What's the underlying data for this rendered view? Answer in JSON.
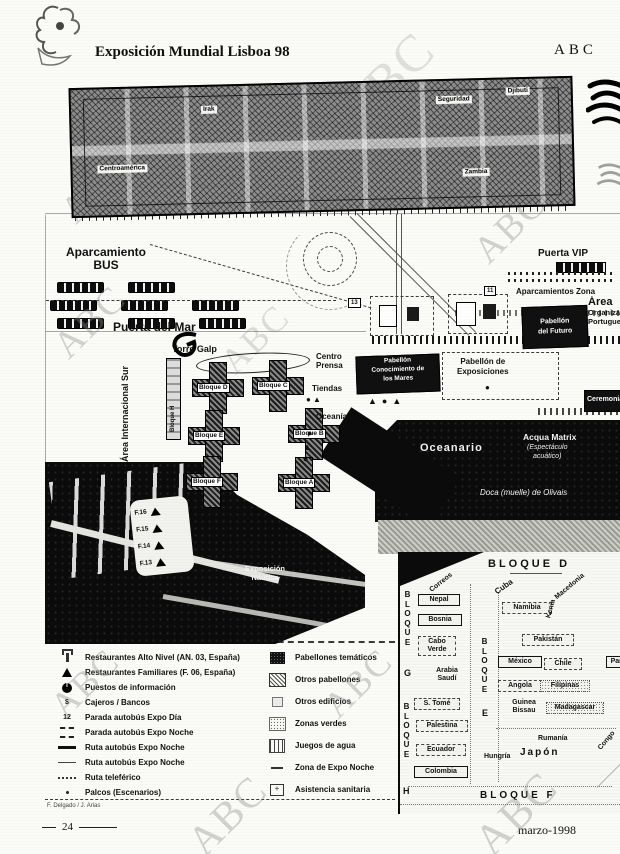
{
  "page": {
    "title": "Exposición Mundial Lisboa 98",
    "brand": "ABC",
    "watermark": "ABC",
    "page_number": "24",
    "date": "marzo-1998",
    "credit": "F. Delgado / J. Arias"
  },
  "top_map": {
    "labels": {
      "irak": "Irak",
      "centroamerica": "Centroamérica",
      "seguridad": "Seguridad",
      "djibuti": "Djibuti",
      "zambia": "Zambia"
    }
  },
  "main_map": {
    "aparcamiento_line1": "Aparcamiento",
    "aparcamiento_line2": "BUS",
    "puerta_del_mar": "Puerta del Mar",
    "torre_galp": "Torre Galp",
    "area_internacional_sur": "Área Internacional Sur",
    "bloque_h_strip": "Bloque H",
    "centro_prensa_line1": "Centro",
    "centro_prensa_line2": "Prensa",
    "tiendas": "Tiendas",
    "oceania": "Oceanía",
    "bloques": [
      "Bloque D",
      "Bloque C",
      "Bloque B",
      "Bloque E",
      "Bloque F",
      "Bloque A"
    ],
    "pabellon_exposiciones_line1": "Pabellón de",
    "pabellon_exposiciones_line2": "Exposiciones",
    "pabellon_futuro_line1": "Pabellón",
    "pabellon_futuro_line2": "del Futuro",
    "pabellon_conocimiento_line1": "Pabellón",
    "pabellon_conocimiento_line2": "Conocimiento de",
    "pabellon_conocimiento_line3": "los Mares",
    "ceremonias": "Ceremonias",
    "puerta_vip": "Puerta VIP",
    "aparcamientos_zona": "Aparcamientos Zona",
    "org_line1": "Área",
    "org_line2": "Organización",
    "org_line3": "Portuguesa",
    "oceanario": "Oceanario",
    "acqua_line1": "Acqua Matrix",
    "acqua_line2": "(Espectáculo",
    "acqua_line3": "acuático)",
    "doca": "Doca (muelle) de Olivais",
    "nautica_line1": "Exposición",
    "nautica_line2": "Náutica",
    "piers": [
      "F.16",
      "F.15",
      "F.14",
      "F.13"
    ],
    "road_numbers": [
      "13",
      "11"
    ]
  },
  "inset": {
    "bloque_d": "BLOQUE D",
    "bloque_f": "BLOQUE F",
    "bloque_vertical_left": "BLOQUE",
    "bloque_vertical_lower": "BLOQUE",
    "bloque_vertical_mid": "BLOQUE",
    "letter_g": "G",
    "letter_e": "E",
    "letter_h": "H",
    "countries": {
      "correos": "Correos",
      "nepal": "Nepal",
      "bosnia": "Bosnia",
      "cabo_verde": "Cabo Verde",
      "arabia_saudi": "Arabia Saudí",
      "s_tome": "S. Tomé",
      "palestina": "Palestina",
      "ecuador": "Ecuador",
      "colombia": "Colombia",
      "cuba": "Cuba",
      "namibia": "Namibia",
      "kenia": "Kenia",
      "macedonia": "Macedonia",
      "pakistan": "Pakistán",
      "mexico": "México",
      "chile": "Chile",
      "angola": "Angola",
      "filipinas": "Filipinas",
      "panama": "Panamá",
      "guinea_bissau": "Guinea Bissau",
      "madagascar": "Madagascar",
      "rumania": "Rumanía",
      "hungria": "Hungría",
      "japon": "Japón",
      "congo": "Congo"
    }
  },
  "legend": {
    "left": [
      {
        "symbol": "restaurant-icon",
        "label": "Restaurantes Alto Nivel (AN. 03, España)"
      },
      {
        "symbol": "triangle-icon",
        "label": "Restaurantes Familiares (F. 06, España)"
      },
      {
        "symbol": "info-circle-icon",
        "label": "Puestos de información"
      },
      {
        "symbol": "dollar-icon",
        "symbol_text": "$",
        "label": "Cajeros / Bancos"
      },
      {
        "symbol": "bus-stop-day-icon",
        "symbol_text": "12",
        "label": "Parada autobús Expo Día"
      },
      {
        "symbol": "bus-stop-night-icon",
        "label": "Parada autobús Expo Noche"
      },
      {
        "symbol": "thick-route-line",
        "label": "Ruta autobús Expo Noche"
      },
      {
        "symbol": "thin-route-line",
        "label": "Ruta autobús Expo Noche"
      },
      {
        "symbol": "dotted-route-line",
        "label": "Ruta teleférico"
      },
      {
        "symbol": "stage-dot-icon",
        "label": "Palcos (Escenarios)"
      }
    ],
    "right": [
      {
        "symbol": "dark-square",
        "label": "Pabellones temáticos"
      },
      {
        "symbol": "hatched-square",
        "label": "Otros pabellones"
      },
      {
        "symbol": "outline-square",
        "label": "Otros edificios"
      },
      {
        "symbol": "stippled-square",
        "label": "Zonas verdes"
      },
      {
        "symbol": "water-square",
        "label": "Juegos de agua"
      },
      {
        "symbol": "dash-line",
        "label": "Zona de Expo Noche"
      },
      {
        "symbol": "medical-square",
        "label": "Asistencia sanitaria"
      }
    ]
  }
}
